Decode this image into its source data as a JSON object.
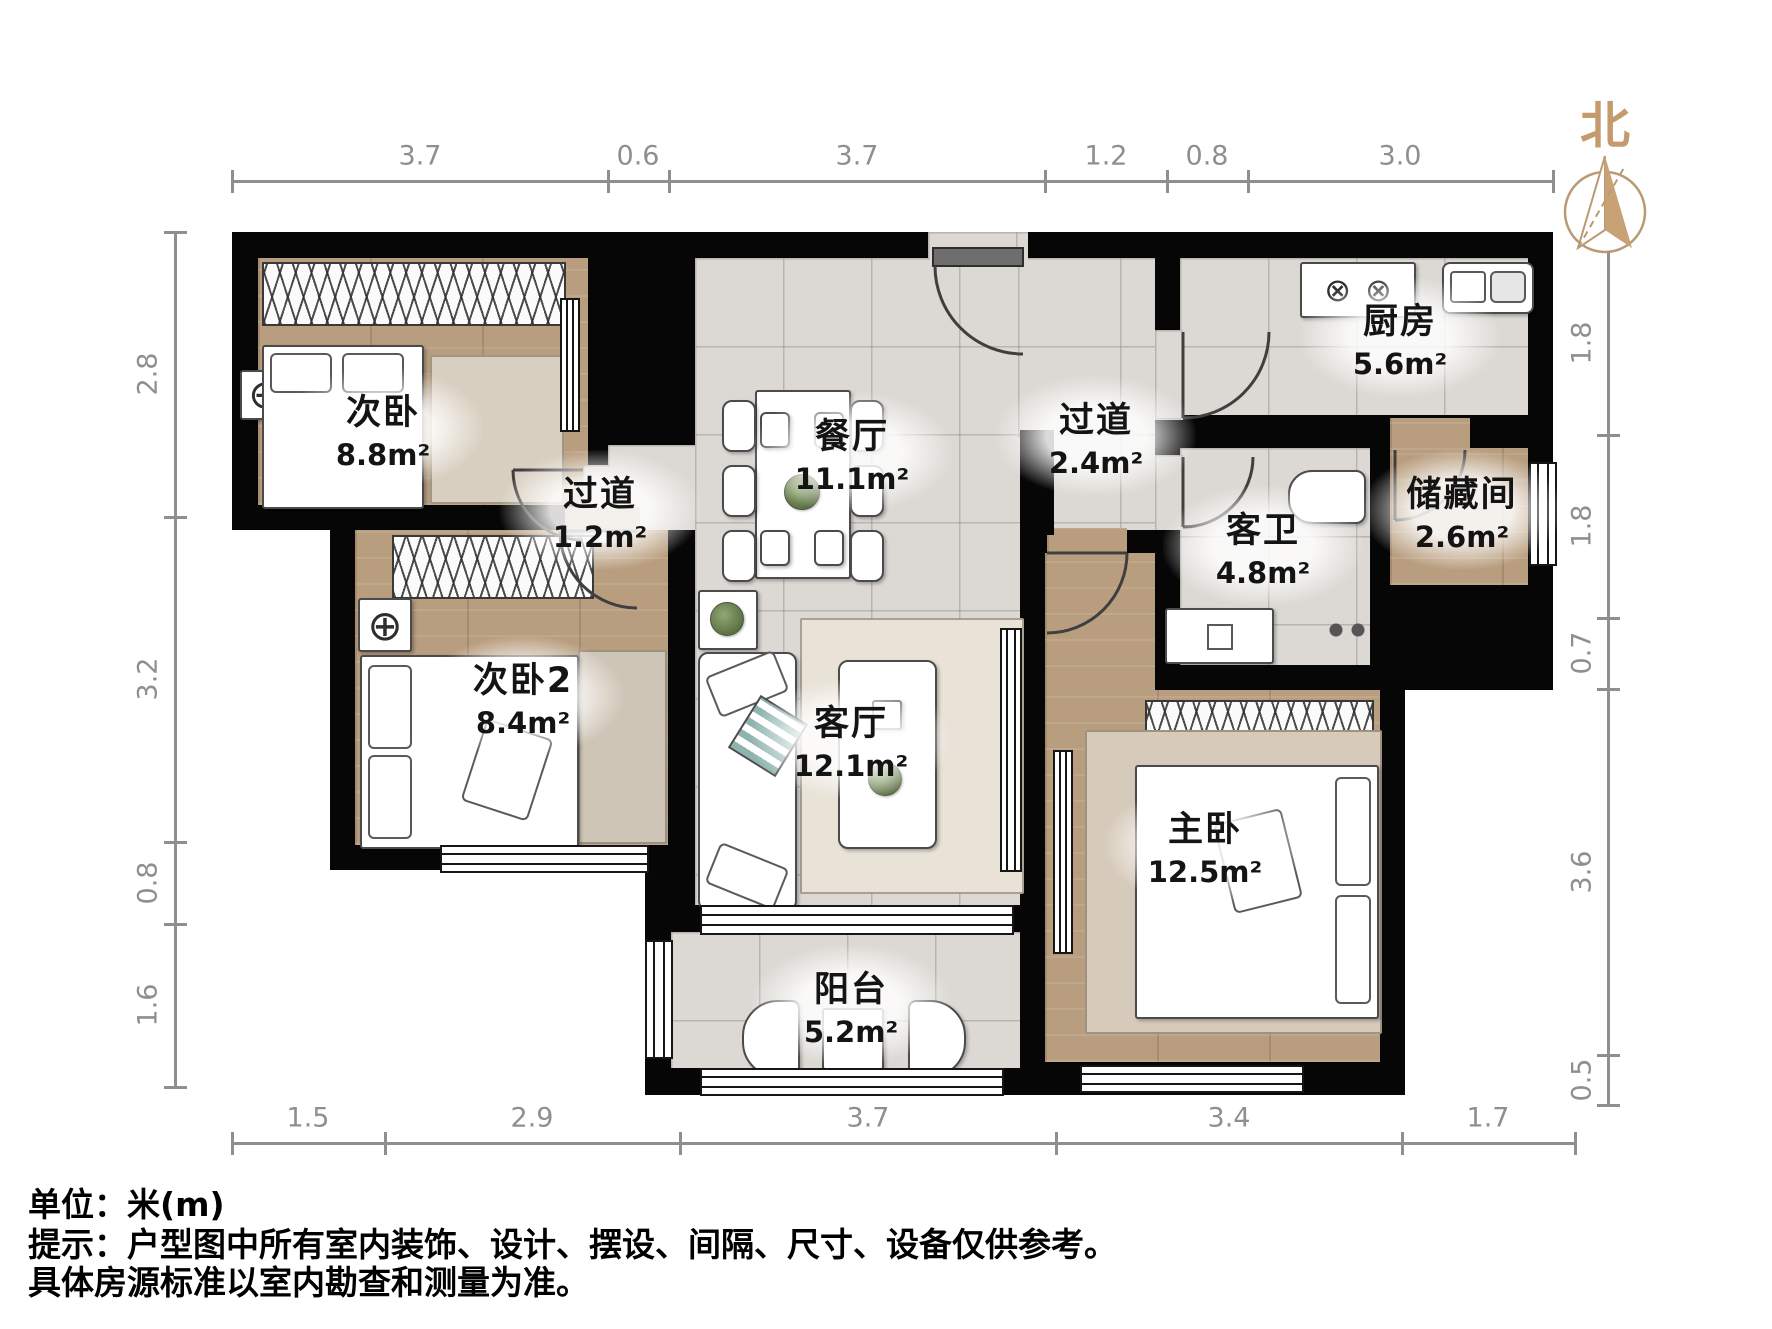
{
  "north": {
    "label": "北"
  },
  "rooms": [
    {
      "id": "bedroom2",
      "name": "次卧",
      "area": "8.8m²"
    },
    {
      "id": "hallway1",
      "name": "过道",
      "area": "1.2m²"
    },
    {
      "id": "dining",
      "name": "餐厅",
      "area": "11.1m²"
    },
    {
      "id": "hallway2",
      "name": "过道",
      "area": "2.4m²"
    },
    {
      "id": "kitchen",
      "name": "厨房",
      "area": "5.6m²"
    },
    {
      "id": "storage",
      "name": "储藏间",
      "area": "2.6m²"
    },
    {
      "id": "guestbath",
      "name": "客卫",
      "area": "4.8m²"
    },
    {
      "id": "bedroom3",
      "name": "次卧2",
      "area": "8.4m²"
    },
    {
      "id": "living",
      "name": "客厅",
      "area": "12.1m²"
    },
    {
      "id": "master",
      "name": "主卧",
      "area": "12.5m²"
    },
    {
      "id": "balcony",
      "name": "阳台",
      "area": "5.2m²"
    }
  ],
  "dimensions": {
    "unit": "m",
    "top": [
      "3.7",
      "0.6",
      "3.7",
      "1.2",
      "0.8",
      "3.0"
    ],
    "bottom": [
      "1.5",
      "2.9",
      "3.7",
      "3.4",
      "1.7"
    ],
    "left": [
      "2.8",
      "3.2",
      "0.8",
      "1.6"
    ],
    "right": [
      "1.8",
      "1.8",
      "0.7",
      "3.6",
      "0.5"
    ]
  },
  "notes": {
    "unit": "单位：米(m)",
    "hint1": "提示：户型图中所有室内装饰、设计、摆设、间隔、尺寸、设备仅供参考。",
    "hint2": "具体房源标准以室内勘查和测量为准。"
  },
  "icons": {
    "ceiling_light": "⊕",
    "burner": "⊗"
  },
  "colors": {
    "wall": "#060606",
    "wood_floor": "#b89d7e",
    "tile_floor": "#dcd9d4",
    "north_accent": "#c8a274",
    "dimension_line": "#8f8f8f",
    "label_text": "#141414"
  }
}
